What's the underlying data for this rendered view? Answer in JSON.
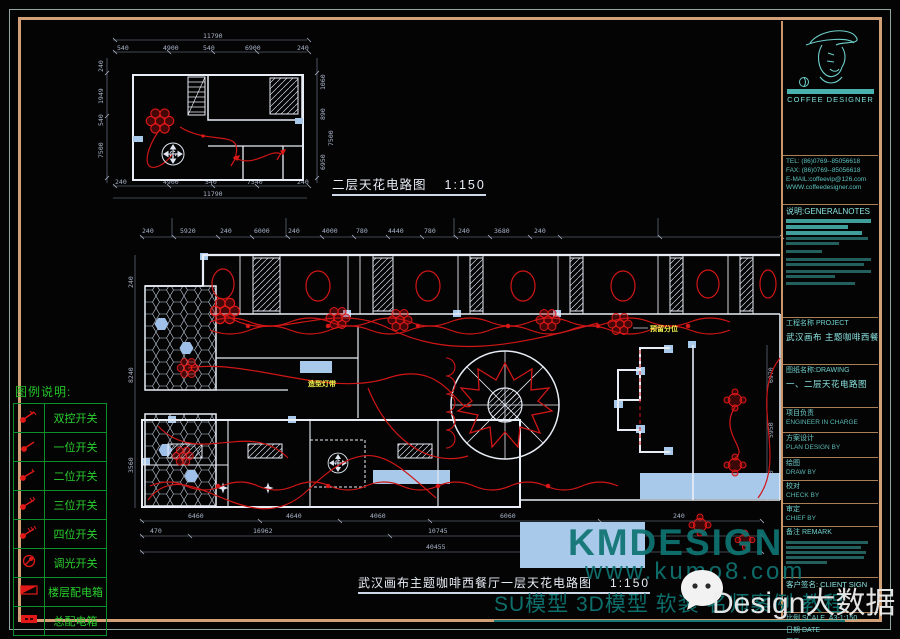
{
  "title_block": {
    "brand": "COFFEE DESIGNER",
    "contact": {
      "tel": "TEL: (86)0769--85056618",
      "fax": "FAX: (86)0769--85056618",
      "email": "E-MAIL:coffeevip@126.com",
      "web": "WWW.coffeedesigner.com"
    },
    "notes_header": "说明:GENERALNOTES",
    "project_label": "工程名称 PROJECT",
    "project_value": "武汉画布 主题咖啡西餐厅",
    "drawing_label": "图纸名称:DRAWING",
    "drawing_value": "一、二层天花电路图",
    "in_charge": "项目负责",
    "in_charge_en": "ENGINEER IN CHARGE",
    "plan_design": "方案设计",
    "plan_design_en": "PLAN DESIGN BY",
    "draw": "绘图",
    "draw_en": "DRAW BY",
    "check": "校对",
    "check_en": "CHECK BY",
    "chief": "审定",
    "chief_en": "CHIEF BY",
    "remark": "备注 REMARK",
    "client": "客户签名: CLIENT SIGN",
    "scale_label": "比例 SCALE",
    "scale_value": "A3-1:150",
    "date_label": "日期 DATE",
    "no_label": "图号 DRAWING NO",
    "no_value": "12"
  },
  "legend": {
    "title": "图例说明:",
    "items": [
      {
        "icon": "switch-double-control-icon",
        "label": "双控开关"
      },
      {
        "icon": "switch-1-gang-icon",
        "label": "一位开关"
      },
      {
        "icon": "switch-2-gang-icon",
        "label": "二位开关"
      },
      {
        "icon": "switch-3-gang-icon",
        "label": "三位开关"
      },
      {
        "icon": "switch-4-gang-icon",
        "label": "四位开关"
      },
      {
        "icon": "dimmer-switch-icon",
        "label": "调光开关"
      },
      {
        "icon": "floor-distribution-box-icon",
        "label": "楼层配电箱"
      },
      {
        "icon": "main-distribution-box-icon",
        "label": "总配电箱"
      }
    ]
  },
  "drawings": {
    "upper": {
      "title": "二层天花电路图",
      "scale": "1:150",
      "dims": {
        "top_total": "11790",
        "top": [
          "540",
          "4900",
          "540",
          "6900",
          "240"
        ],
        "left": [
          "240",
          "1949",
          "540",
          "7500"
        ],
        "right": [
          "1060",
          "890",
          "7500",
          "6950"
        ],
        "bottom": [
          "240",
          "4900",
          "540",
          "7540",
          "240"
        ],
        "bottom_total": "11790"
      }
    },
    "main": {
      "title": "武汉画布主题咖啡西餐厅一层天花电路图",
      "scale": "1:150",
      "annotations": {
        "light_strip": "造型灯带",
        "reserved": "预留分位"
      },
      "dims": {
        "top": [
          "240",
          "5920",
          "240",
          "6000",
          "240",
          "4000",
          "780",
          "4440",
          "780",
          "240",
          "3680",
          "240"
        ],
        "left": [
          "240",
          "8240",
          "3560"
        ],
        "right": [
          "6970",
          "5950",
          "3550"
        ],
        "bottom_row1": [
          "6460",
          "4640",
          "4060",
          "6060",
          "240"
        ],
        "bottom_row2": [
          "470",
          "16962",
          "10745",
          "9092"
        ],
        "bottom_total": "40455"
      }
    }
  },
  "watermark": {
    "brand": "KMDESIGN",
    "url": "www.kumo8.com",
    "tags": "SU模型 3D模型 软装 名师案例 教程",
    "white_text": "Design大数据"
  }
}
